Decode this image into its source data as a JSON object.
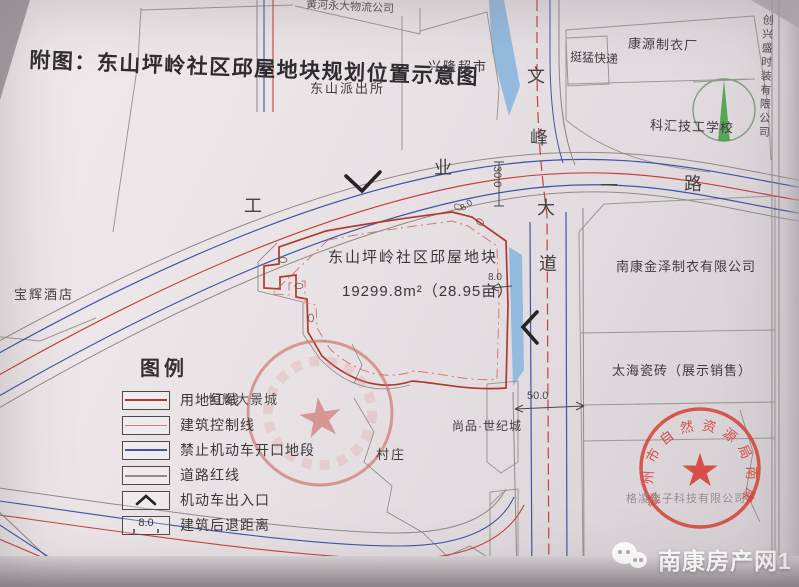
{
  "title": "附图：东山坪岭社区邱屋地块规划位置示意图",
  "labels": {
    "logistics": "黄河永大物流公司",
    "police_station": "东山派出所",
    "supermarket": "兴隆超市",
    "express": "挺猛快递",
    "garment_factory": "康源制衣厂",
    "tech_school": "科汇技工学校",
    "fashion_co": "创兴盛时装有限公司",
    "jinze_clothing": "南康金泽制衣有限公司",
    "taihai_tiles": "太海瓷砖（展示销售）",
    "hotel": "宝辉酒店",
    "henghui": "恒辉大景城",
    "village": "村庄",
    "shangpin": "尚品·世纪城"
  },
  "roads": {
    "wenfeng": {
      "name": "文峰大道",
      "chars": [
        "文",
        "峰",
        "大",
        "道"
      ]
    },
    "gongye": {
      "name": "工业一路",
      "chars": [
        "工",
        "业",
        "一",
        "路"
      ]
    }
  },
  "parcel": {
    "name": "东山坪岭社区邱屋地块",
    "area": "19299.8m²（28.95亩）"
  },
  "dimensions": {
    "road_width": "30.0",
    "setback": "8.0",
    "south_road_width": "50.0"
  },
  "legend": {
    "title": "图例",
    "items": [
      {
        "label": "用地红线"
      },
      {
        "label": "建筑控制线"
      },
      {
        "label": "禁止机动车开口地段"
      },
      {
        "label": "道路红线"
      },
      {
        "label": "机动车出入口"
      },
      {
        "label": "建筑后退距离"
      }
    ],
    "setback_value": "8.0"
  },
  "stamps": {
    "bureau": {
      "text": "赣州市自然资源局南康分局",
      "star": "★"
    },
    "community": {
      "star": "★"
    },
    "underlay": "格凌电子科技有限公司"
  },
  "watermark": {
    "text": "南康房产网1"
  },
  "colors": {
    "parcel_red": "#b0392e",
    "control_red": "#cf7b72",
    "no_opening_blue": "#3c55a5",
    "road_gray": "#8f8b88",
    "water_blue": "#85b4de",
    "stamp_red": "#d5453a",
    "north_green": "#4aa04a"
  }
}
